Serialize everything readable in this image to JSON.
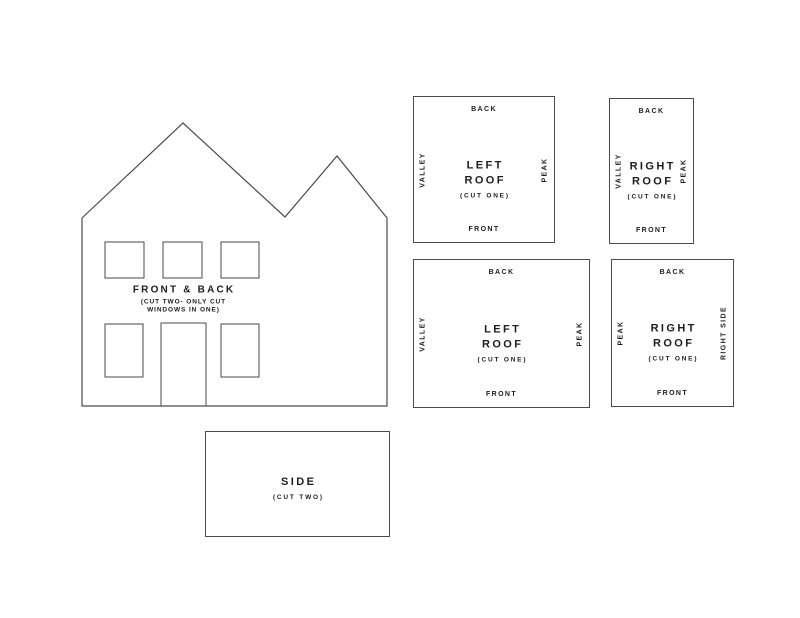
{
  "document": {
    "background_color": "#ffffff",
    "line_color": "#4a4a4a",
    "text_color": "#1d1d1d"
  },
  "house": {
    "label": "FRONT & BACK",
    "note_line1": "(CUT TWO- ONLY CUT",
    "note_line2": "WINDOWS IN ONE)"
  },
  "panels": [
    {
      "title_line1": "LEFT",
      "title_line2": "ROOF",
      "cut_note": "(CUT ONE)",
      "edge_top": "BACK",
      "edge_bottom": "FRONT",
      "edge_left": "VALLEY",
      "edge_right": "PEAK"
    },
    {
      "title_line1": "RIGHT",
      "title_line2": "ROOF",
      "cut_note": "(CUT ONE)",
      "edge_top": "BACK",
      "edge_bottom": "FRONT",
      "edge_left": "VALLEY",
      "edge_right": "PEAK"
    },
    {
      "title_line1": "LEFT",
      "title_line2": "ROOF",
      "cut_note": "(CUT ONE)",
      "edge_top": "BACK",
      "edge_bottom": "FRONT",
      "edge_left": "VALLEY",
      "edge_right": "PEAK"
    },
    {
      "title_line1": "RIGHT",
      "title_line2": "ROOF",
      "cut_note": "(CUT ONE)",
      "edge_top": "BACK",
      "edge_bottom": "FRONT",
      "edge_left": "PEAK",
      "edge_right": "RIGHT SIDE"
    }
  ],
  "side_panel": {
    "title": "SIDE",
    "cut_note": "(CUT TWO)"
  }
}
